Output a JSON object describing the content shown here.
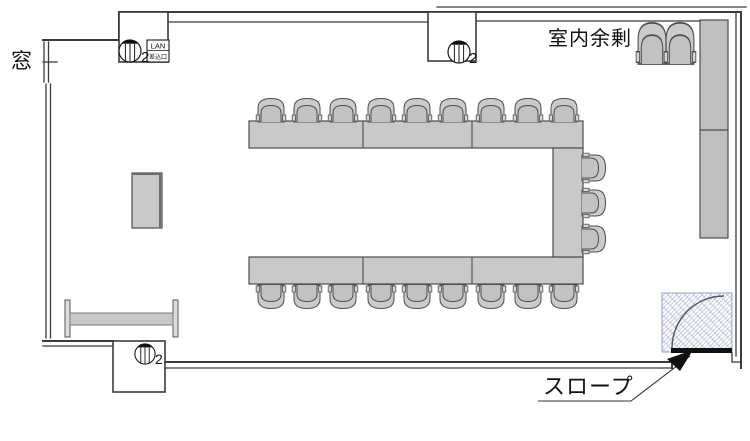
{
  "drawing": {
    "type": "room floor plan",
    "labels": {
      "window": "窓",
      "room_surplus": "室内余剰",
      "ramp": "スロープ",
      "lan_box": {
        "line1": "LAN",
        "line2": "差込口"
      },
      "outlet_counts": {
        "top_left": "2",
        "top_center": "2",
        "bottom_left": "2"
      }
    },
    "furniture_summary": {
      "u_table_segments": 7,
      "seats_top_row": 9,
      "seats_bottom_row": 9,
      "seats_right_side": 3,
      "stacked_spare_chairs": 2,
      "side_table": 1,
      "folding_board": 1,
      "wall_column_sections": 2,
      "outlet_symbols": 3,
      "door_with_swing": 1
    },
    "colors": {
      "background": "#ffffff",
      "wall": "#3b3b3b",
      "furniture_fill": "#c9c9c9",
      "furniture_stroke": "#4d4d4d",
      "column_fill": "#bfbfbf",
      "door_hatch": "#aab3d0",
      "door_leaf": "#111111"
    }
  }
}
